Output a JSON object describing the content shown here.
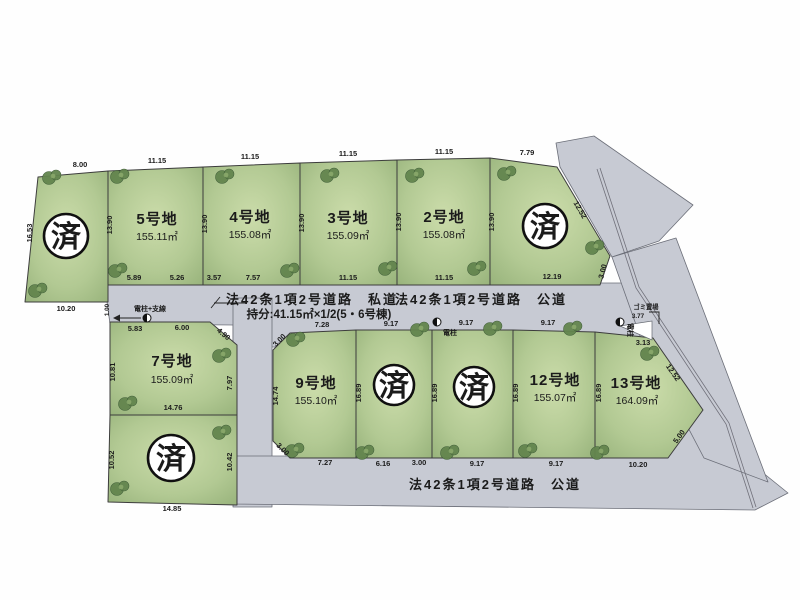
{
  "stamp_text": "済",
  "plots": {
    "s1": {
      "m": {
        "top": "8.00",
        "left": "16.53",
        "bottom": "10.20"
      }
    },
    "p5": {
      "name": "5号地",
      "area": "155.11㎡",
      "m": {
        "top": "11.15",
        "left": "13.90",
        "b1": "5.89",
        "b2": "5.26"
      }
    },
    "p4": {
      "name": "4号地",
      "area": "155.08㎡",
      "m": {
        "top": "11.15",
        "left": "13.90",
        "b1": "3.57",
        "b2": "7.57"
      }
    },
    "p3": {
      "name": "3号地",
      "area": "155.09㎡",
      "m": {
        "top": "11.15",
        "left": "13.90",
        "bottom": "11.15"
      }
    },
    "p2": {
      "name": "2号地",
      "area": "155.08㎡",
      "m": {
        "top": "11.15",
        "left": "13.90",
        "bottom": "11.15"
      }
    },
    "s2": {
      "m": {
        "top": "7.79",
        "left": "13.90",
        "ne_diag": "12.52",
        "corner": "3.00",
        "bottom": "12.19"
      }
    },
    "p7": {
      "name": "7号地",
      "area": "155.09㎡",
      "m": {
        "t1": "5.83",
        "t2": "6.00",
        "diag": "4.90",
        "left": "10.81",
        "right": "7.97",
        "bottom": "14.76"
      }
    },
    "s3": {
      "m": {
        "left": "10.52",
        "right": "10.42",
        "bottom": "14.85"
      }
    },
    "p9": {
      "name": "9号地",
      "area": "155.10㎡",
      "m": {
        "nw": "3.00",
        "top": "7.28",
        "left": "14.74",
        "sw": "3.00",
        "bottom": "7.27"
      }
    },
    "s4": {
      "m": {
        "top": "9.17",
        "left": "16.89",
        "b1": "6.16",
        "b2": "3.00"
      }
    },
    "s5": {
      "m": {
        "top": "9.17",
        "left": "16.89",
        "bottom": "9.17"
      }
    },
    "p12": {
      "name": "12号地",
      "area": "155.07㎡",
      "m": {
        "top": "9.17",
        "left": "16.89",
        "bottom": "9.17"
      }
    },
    "p13": {
      "name": "13号地",
      "area": "164.09㎡",
      "m": {
        "top": "3.13",
        "left": "16.89",
        "ne_diag": "12.52",
        "se_diag": "5.00",
        "bottom": "10.20"
      }
    }
  },
  "roads": {
    "private_road_label": "法42条1項2号道路　私道",
    "private_road_share": "持分:41.15㎡×1/2(5・6号棟)",
    "public_road_label_top": "法42条1項2号道路　公道",
    "public_road_label_bottom": "法42条1項2号道路　公道"
  },
  "annotations": {
    "pole_with_wire": "電柱+支線",
    "pole_wire_dim": "1.00",
    "pole1": "電柱",
    "pole2": "電柱",
    "garbage_place": "ゴミ置場",
    "garbage_dim": "3.77"
  },
  "colors": {
    "road_gray": "#c7cad3",
    "plot_green": "#aec68f",
    "tree_green": "#63854e",
    "stamp_ink": "#101010"
  }
}
